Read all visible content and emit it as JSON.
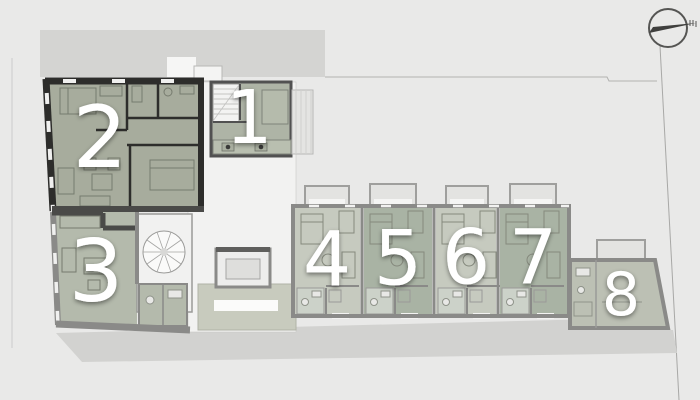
{
  "plan": {
    "street_label": "Baross utca 40.",
    "units": [
      {
        "number": "1"
      },
      {
        "number": "2"
      },
      {
        "number": "3"
      },
      {
        "number": "4"
      },
      {
        "number": "5"
      },
      {
        "number": "6"
      },
      {
        "number": "7"
      },
      {
        "number": "8"
      }
    ],
    "icons": {
      "north_arrow": "north-arrow-icon"
    }
  },
  "colors": {
    "background": "#e9e9e8",
    "neighbor_building": "#d4d4d2",
    "street_band": "#d2d2d0",
    "courtyard": "#f2f2f1",
    "unit1_green": "#aeb4a6",
    "unit2_green": "#a7ac9d",
    "unit3_green": "#b4baac",
    "unit_green_light": "#c6cabf",
    "unit_green_dark": "#a9b3a4",
    "unit8_green": "#bcc0b4",
    "patio_green": "#c8cbbe",
    "wall_black": "#2d2d2b",
    "wall_gray": "#8a8a88",
    "number_white": "#ffffff",
    "label_gray": "#8e8e8c"
  }
}
